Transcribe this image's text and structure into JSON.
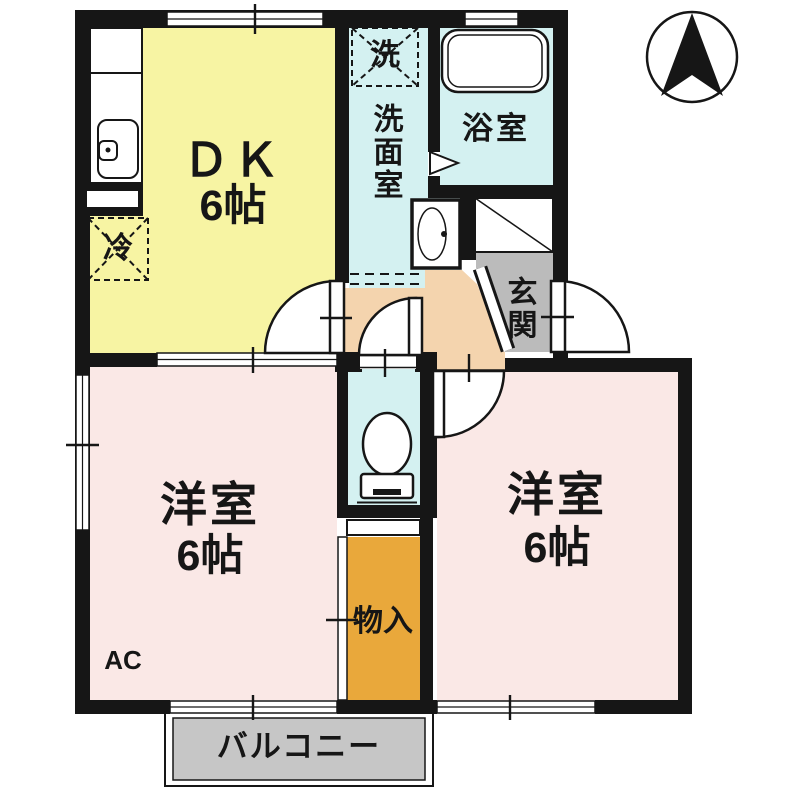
{
  "plan_title": "1DK apartment floor plan",
  "rooms": {
    "dk": {
      "label": "ＤＫ",
      "size": "6帖"
    },
    "washroom": {
      "label": "洗面室"
    },
    "bathroom": {
      "label": "浴室"
    },
    "entrance": {
      "label": "玄関"
    },
    "western_left": {
      "label": "洋室",
      "size": "6帖"
    },
    "western_right": {
      "label": "洋室",
      "size": "6帖"
    },
    "storage": {
      "label": "物入"
    },
    "balcony": {
      "label": "バルコニー"
    }
  },
  "fixtures": {
    "washing_machine": "洗",
    "refrigerator": "冷",
    "air_conditioner": "AC"
  },
  "colors": {
    "dk_yellow": "#F7F4A3",
    "wet_area_cyan": "#D4F1F1",
    "room_pink": "#FAE8E6",
    "hall_peach": "#F4D4AE",
    "entrance_gray": "#BBBBBB",
    "balcony_gray": "#C6C6C6",
    "storage_orange": "#E9A83B",
    "wall_black": "#161616"
  }
}
